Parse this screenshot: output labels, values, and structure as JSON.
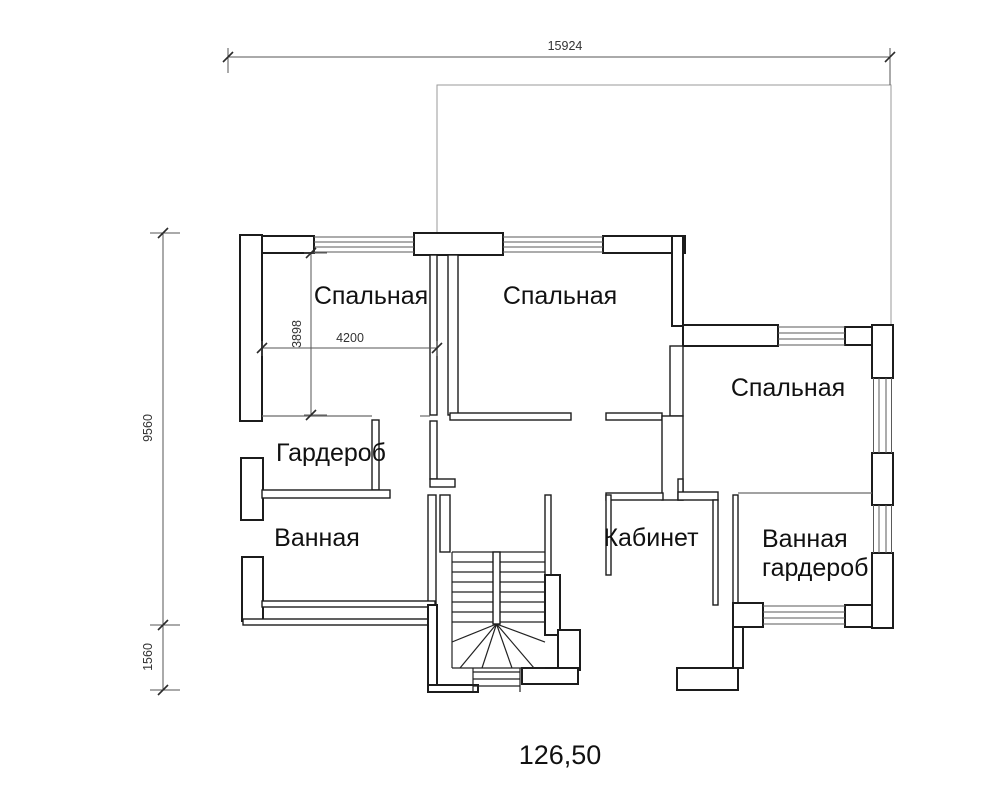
{
  "drawing_type": "floor-plan",
  "dimensions": {
    "overall_width_mm": "15924",
    "left_height_upper_mm": "9560",
    "left_height_lower_mm": "1560",
    "bedroom1_width_mm": "4200",
    "bedroom1_depth_mm": "3898"
  },
  "rooms": {
    "bedroom1": {
      "label": "Спальная"
    },
    "bedroom2": {
      "label": "Спальная"
    },
    "bedroom3": {
      "label": "Спальная"
    },
    "wardrobe": {
      "label": "Гардероб"
    },
    "bathroom": {
      "label": "Ванная"
    },
    "study": {
      "label": "Кабинет"
    },
    "bath_wardrobe": {
      "label_line1": "Ванная",
      "label_line2": "гардероб"
    }
  },
  "footer": {
    "total_area": "126,50"
  },
  "colors": {
    "background": "#ffffff",
    "wall_line": "#1c1c1c",
    "thin_line": "#9a9a9a",
    "glazing_line": "#5a5a5a",
    "dimension_line": "#555555",
    "text": "#111111"
  }
}
